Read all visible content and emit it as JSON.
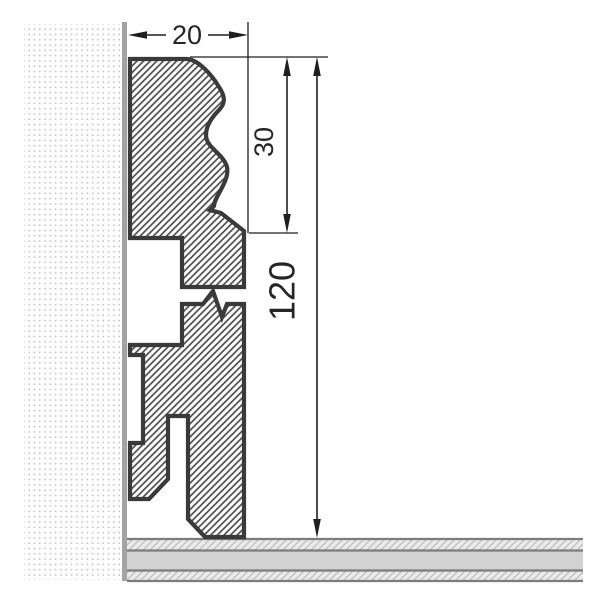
{
  "drawing": {
    "title": "Skirting board profile cross-section",
    "dims": {
      "width": "20",
      "upper_height": "30",
      "total_height": "120"
    },
    "colors": {
      "outline": "#3a3a3a",
      "hatch_line": "#4d4d4d",
      "wall_face": "#a3a3a3",
      "wall_dots": "#c4c4c4",
      "floor_band": "#d2d2d2",
      "floor_hatch_bg": "#ebebeb",
      "floor_hatch_line": "#c2c2c2",
      "floor_border": "#7d7d7d",
      "dimension_lines": "#1f1f1f"
    }
  }
}
